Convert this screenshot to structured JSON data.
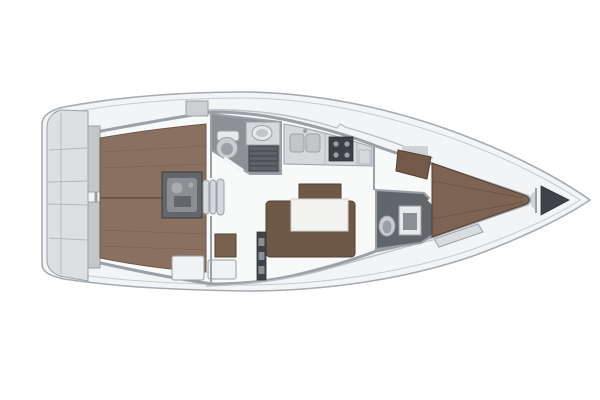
{
  "colors": {
    "background": "#ffffff",
    "hull_fill": "#f3f4f6",
    "interior_floor": "#f8f9f9",
    "platform": "#dde0e2",
    "helm_seat": "#c3c7ca",
    "teak": "#8a7060",
    "engine_box": "#63676b",
    "engine_metal": "#8b8f93",
    "engine_detail": "#a9adb0",
    "step": "#d6d9db",
    "hatch": "#ccd0d3",
    "locker_white": "#f1f2f3",
    "aft_head_floor": "#8d9195",
    "fwd_head_floor": "#61666a",
    "grate": "#5e6266",
    "fixture": "#e7e9eb",
    "toilet": "#c9cdd0",
    "toilet_inner": "#9aa0a3",
    "counter": "#d6d9db",
    "sink_steel": "#c2c6c9",
    "sink_bowl": "#e6e8ea",
    "stove": "#3d4145",
    "burner": "#9aa0a4",
    "settee": "#6e5847",
    "seat_wood": "#79614f",
    "berth": "#7d6452",
    "wardrobe": "#74594a",
    "table": "#f2f2f1",
    "dark_locker": "#3f4347",
    "anchor_locker": "#3f4347",
    "shelf": "#cfd3d5",
    "bench": "#d9dcde"
  }
}
